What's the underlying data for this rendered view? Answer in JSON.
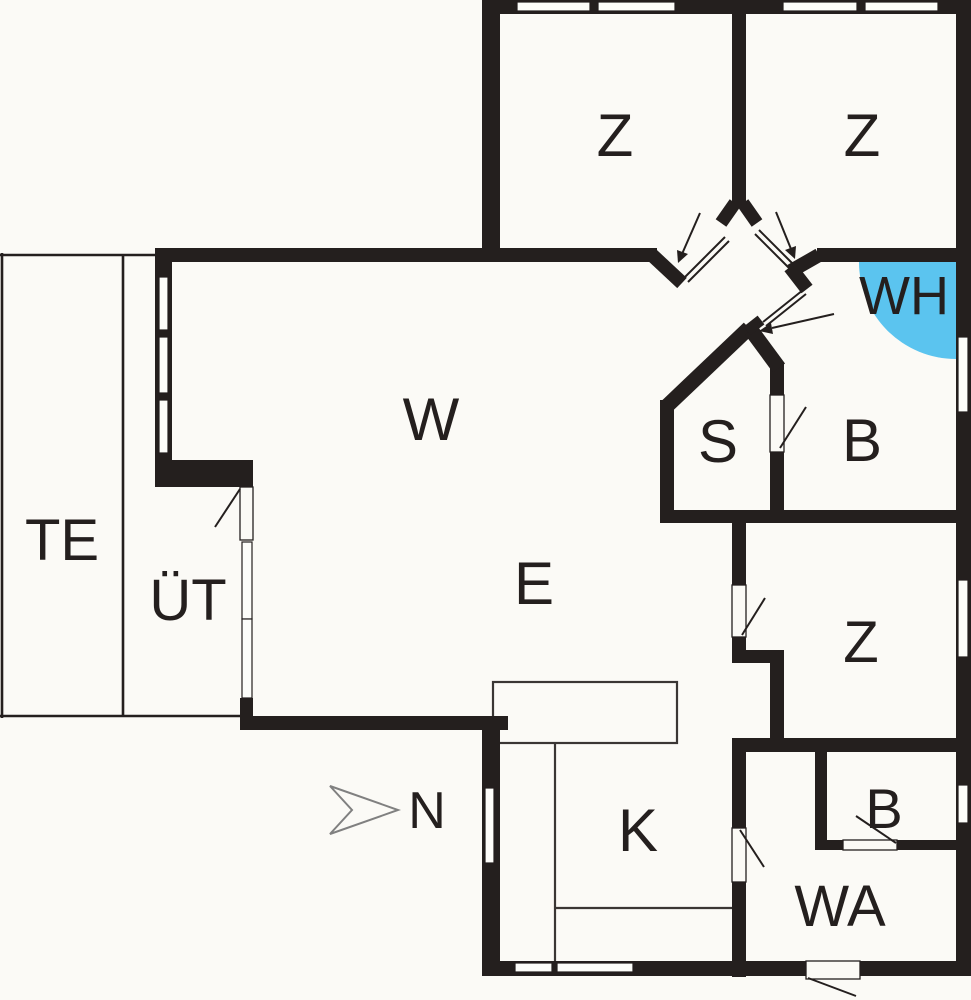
{
  "title": "Holiday house floor plan",
  "colors": {
    "wall": "#241f1e",
    "floor": "#fbfaf6",
    "whirlpool_accent": "#5bc4ef",
    "north_arrow_outline": "#808080"
  },
  "rooms": [
    {
      "id": "bedroom-top-left",
      "label": "Z"
    },
    {
      "id": "bedroom-top-right",
      "label": "Z"
    },
    {
      "id": "whirlpool",
      "label": "WH"
    },
    {
      "id": "living-room",
      "label": "W"
    },
    {
      "id": "sauna",
      "label": "S"
    },
    {
      "id": "bathroom-main",
      "label": "B"
    },
    {
      "id": "terrace",
      "label": "TE"
    },
    {
      "id": "covered-terrace",
      "label": "ÜT"
    },
    {
      "id": "dining-area",
      "label": "E"
    },
    {
      "id": "bedroom-right",
      "label": "Z"
    },
    {
      "id": "kitchen",
      "label": "K"
    },
    {
      "id": "bathroom-small",
      "label": "B"
    },
    {
      "id": "utility-room",
      "label": "WA"
    }
  ],
  "compass": {
    "label": "N"
  }
}
